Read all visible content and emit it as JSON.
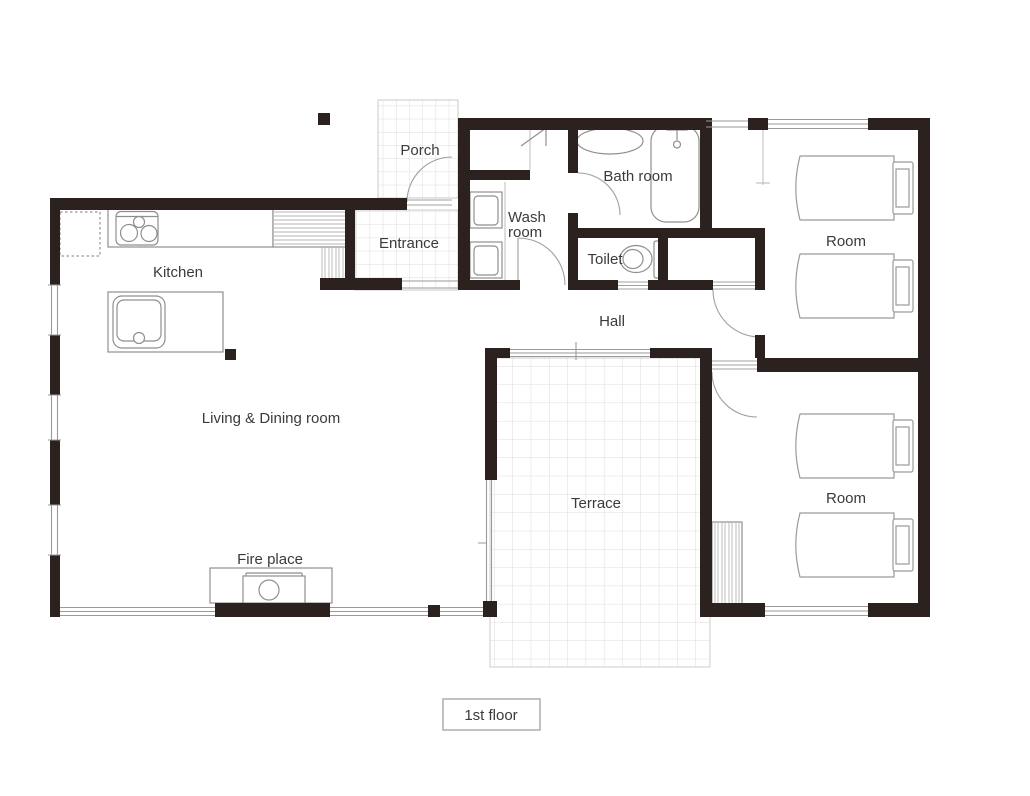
{
  "plan": {
    "floor_tag": "1st floor",
    "rooms": {
      "porch": "Porch",
      "entrance": "Entrance",
      "kitchen": "Kitchen",
      "wash_room_line1": "Wash",
      "wash_room_line2": "room",
      "bath_room": "Bath room",
      "toilet": "Toilet",
      "hall": "Hall",
      "room_upper": "Room",
      "room_lower": "Room",
      "living_dining": "Living & Dining room",
      "fire_place": "Fire place",
      "terrace": "Terrace"
    },
    "fixtures": [
      "refrigerator-space",
      "gas-stove",
      "kitchen-counter",
      "shoe-cabinet",
      "entrance-step",
      "island-sink",
      "fireplace",
      "washbasin-upper",
      "washbasin-lower",
      "laundry-closet",
      "vanity-oval",
      "bathtub",
      "toilet-bowl",
      "bed-upper-room-1",
      "bed-upper-room-2",
      "bed-lower-room-1",
      "bed-lower-room-2",
      "closet-shelves"
    ],
    "colors": {
      "wall": "#2b2220",
      "fixture_line": "#8f8f8f",
      "grid_line": "#d4d4d4",
      "text": "#3a3a3a",
      "background": "#ffffff"
    }
  }
}
